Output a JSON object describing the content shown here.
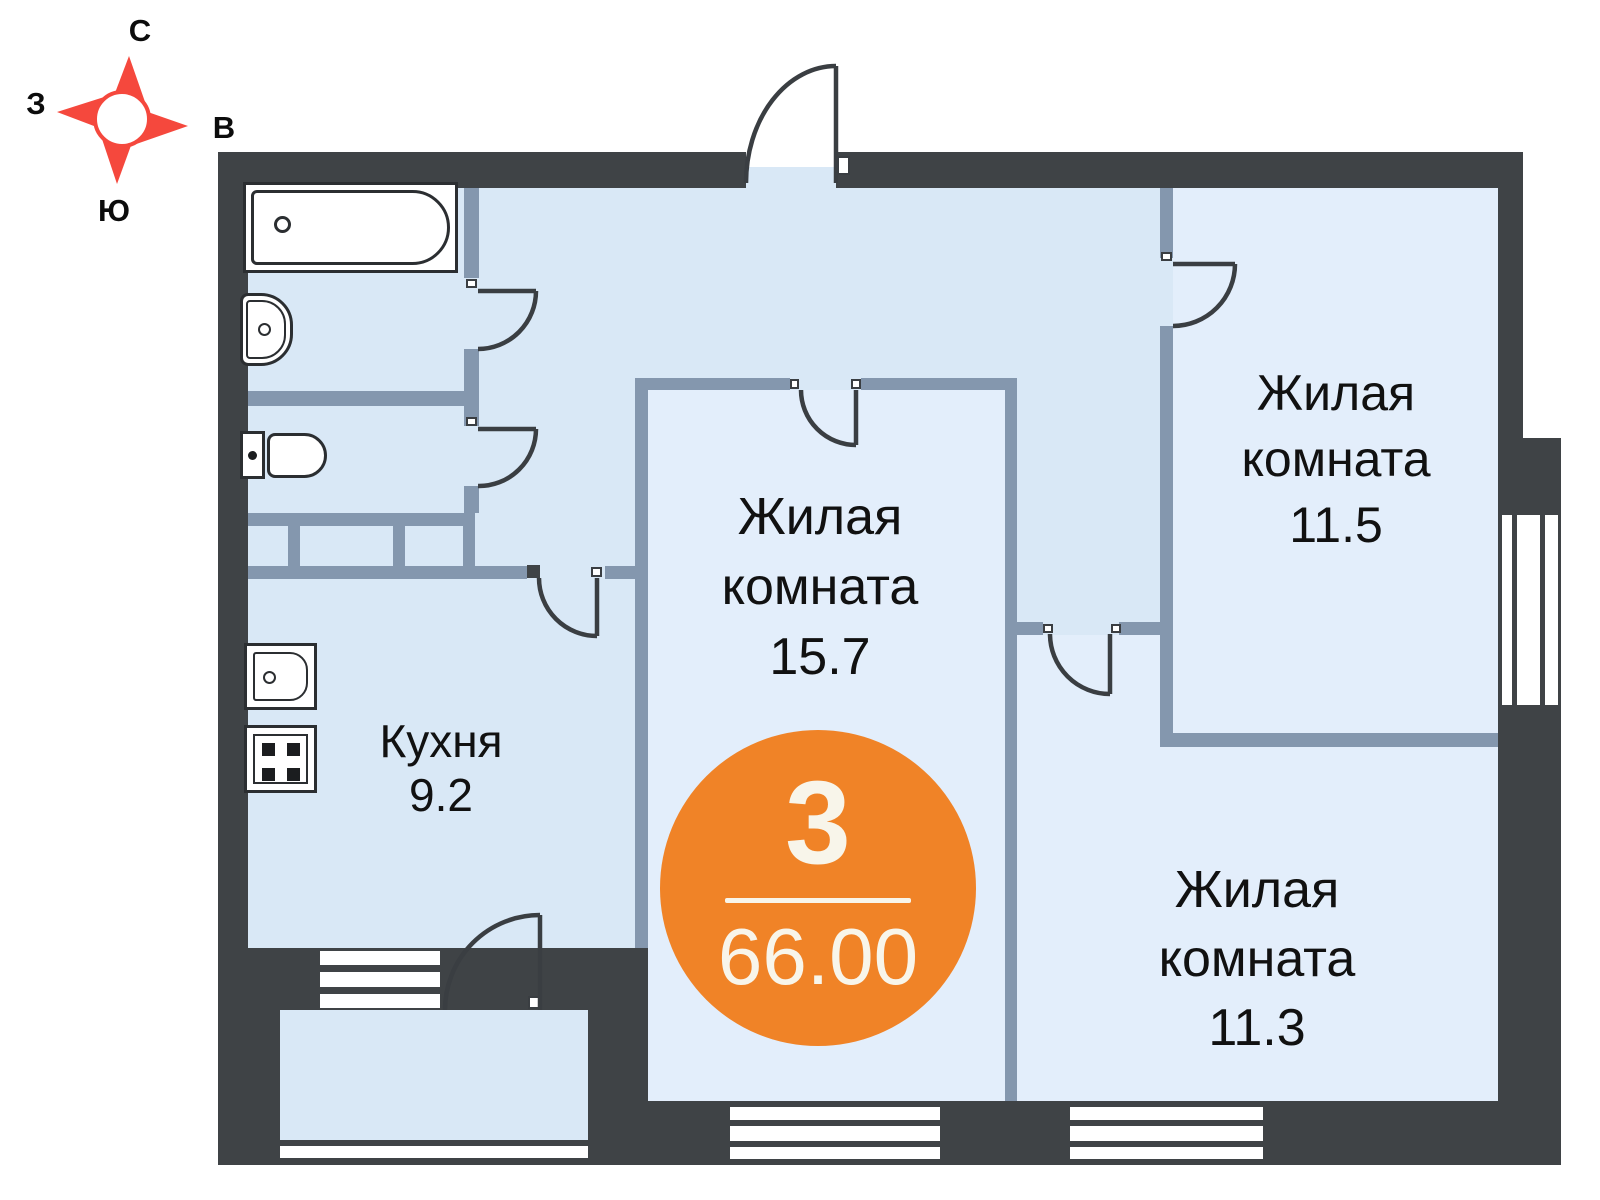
{
  "plan": {
    "type_label": "floor-plan",
    "badge": {
      "room_count": "3",
      "total_area": "66.00"
    },
    "rooms": {
      "living1": {
        "line1": "Жилая",
        "line2": "комната",
        "area": "15.7"
      },
      "living2": {
        "line1": "Жилая",
        "line2": "комната",
        "area": "11.5"
      },
      "living3": {
        "line1": "Жилая",
        "line2": "комната",
        "area": "11.3"
      },
      "kitchen": {
        "name": "Кухня",
        "area": "9.2"
      }
    }
  },
  "compass": {
    "north": "С",
    "south": "Ю",
    "west": "З",
    "east": "В"
  },
  "colors": {
    "outer_wall": "#3f4346",
    "partition": "#8497ae",
    "hall_floor": "#d9e8f6",
    "room_floor": "#e3eefb",
    "badge_orange": "#f08327",
    "badge_text": "#f8f5ea",
    "compass_red": "#f5483d",
    "door_stroke": "#3a3e42"
  }
}
